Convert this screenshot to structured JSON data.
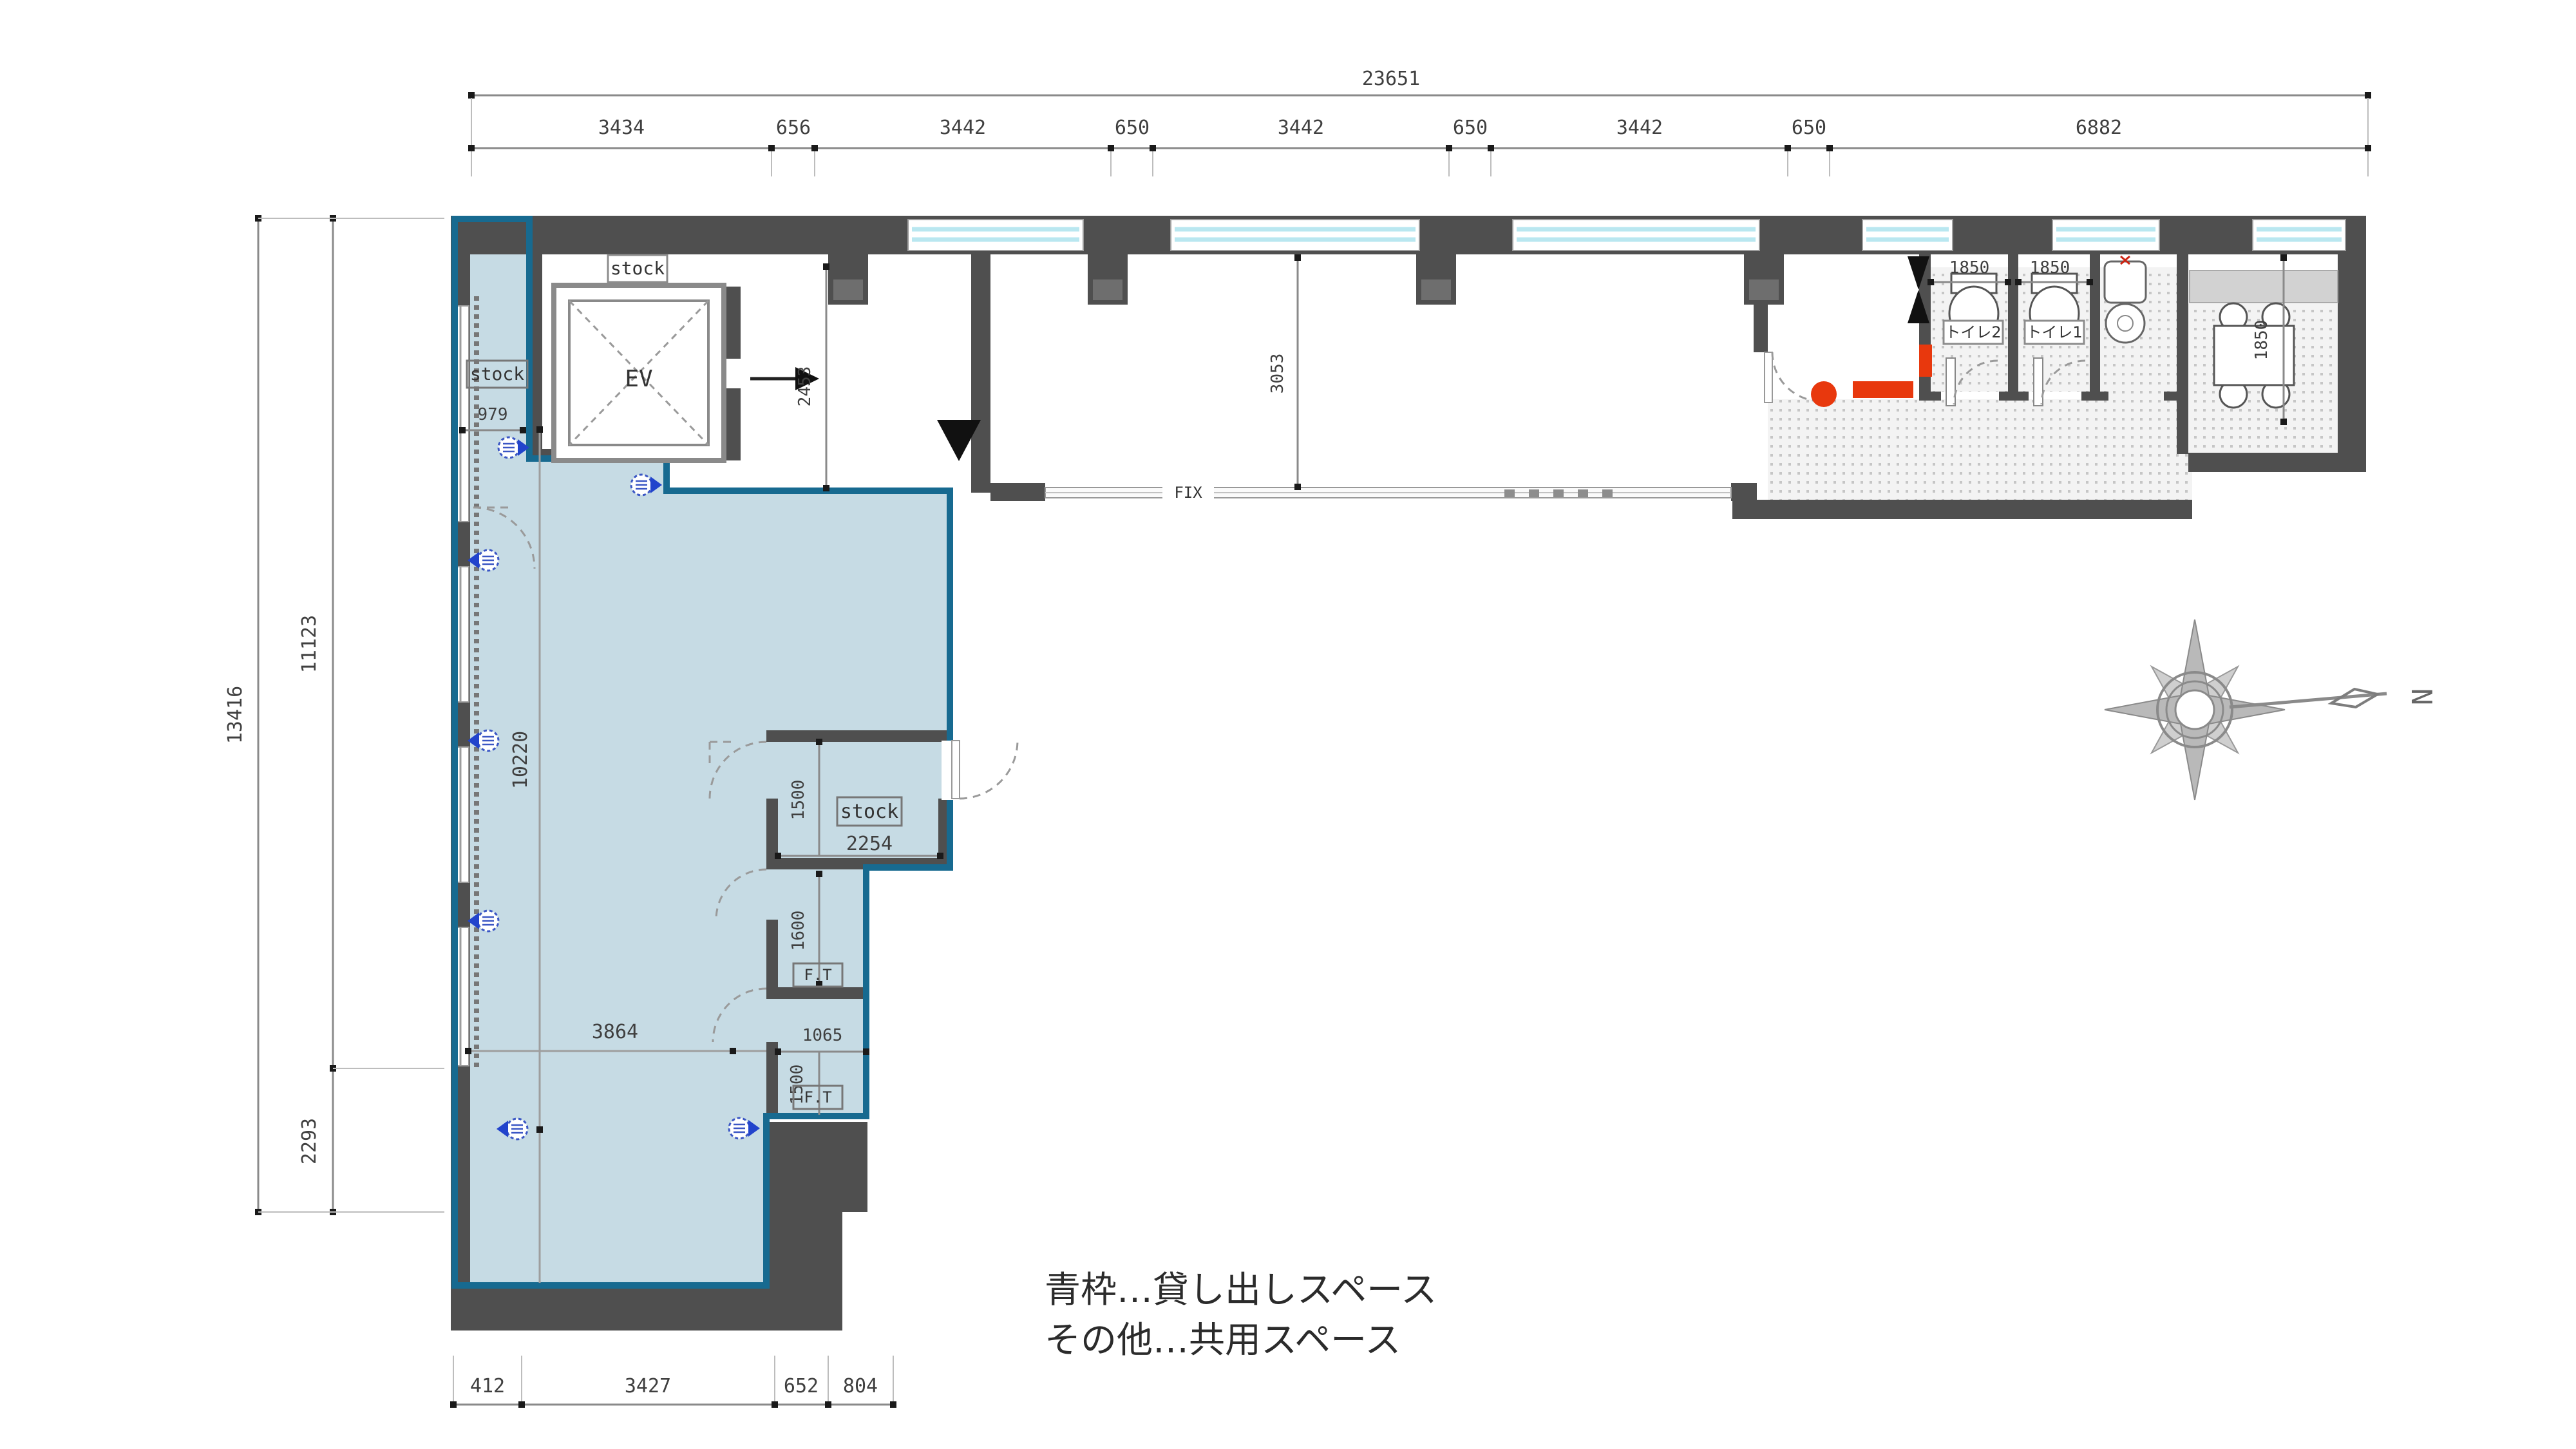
{
  "legend": {
    "line1": "青枠…貸し出しスペース",
    "line2": "その他…共用スペース"
  },
  "compass": {
    "north": "N"
  },
  "labels": {
    "ev": "EV",
    "stock": "stock",
    "fix": "FIX",
    "ft": "F.T",
    "toilet1": "トイレ1",
    "toilet2": "トイレ2"
  },
  "dims": {
    "top": {
      "total": "23651",
      "segments": [
        "3434",
        "656",
        "3442",
        "650",
        "3442",
        "650",
        "3442",
        "650",
        "6882"
      ]
    },
    "left": {
      "outer": "13416",
      "upper": "11123",
      "lower": "2293"
    },
    "bottom": {
      "segments": [
        "412",
        "3427",
        "652",
        "804"
      ]
    },
    "interior": {
      "stock_left_width": "979",
      "entry_depth": "2453",
      "hall_depth": "3053",
      "stock_center_height": "1500",
      "stock_center_width": "2254",
      "ft_zone_height": "1600",
      "ft_zone_width": "1065",
      "ft_lower_height": "1500",
      "main_width": "3864",
      "main_height": "10220",
      "toilet2_width": "1850",
      "toilet1_width": "1850",
      "kitchen_depth": "1850"
    }
  },
  "colors": {
    "rental_fill": "#c6dbe4",
    "rental_border": "#176a90",
    "wall": "#4f4f4f",
    "window": "#bfe9f2",
    "accent_red": "#e8380d",
    "marker_blue": "#2244cc"
  }
}
